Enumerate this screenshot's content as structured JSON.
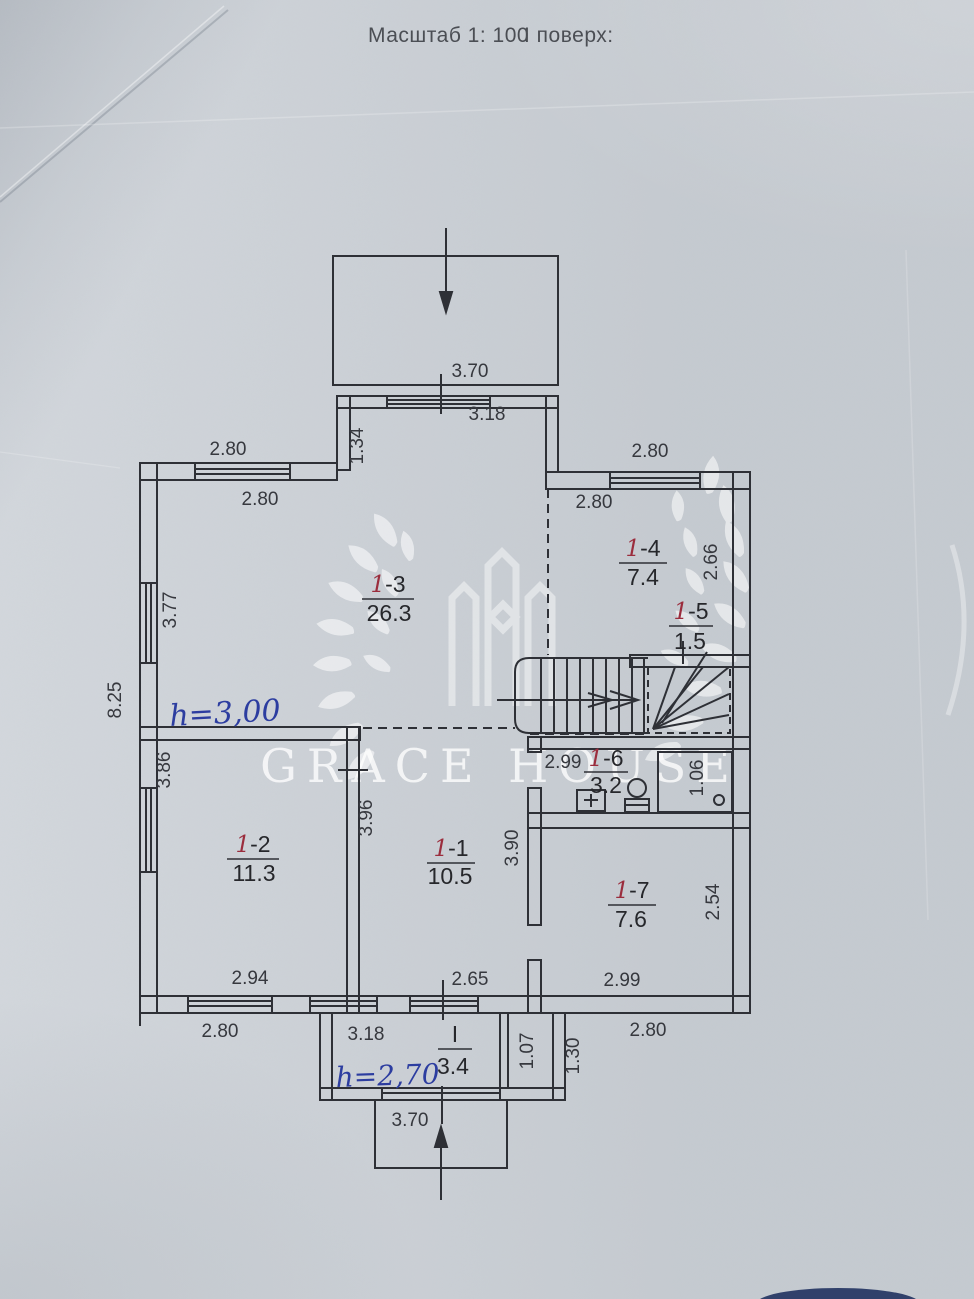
{
  "document": {
    "scale_label": "Масштаб 1: 100",
    "floor_label": "І поверх:",
    "watermark_text": "GRACE HOUSE",
    "height_note_main": "h=3,00",
    "height_note_vestibule": "h=2,70"
  },
  "colors": {
    "paper": "#cdd2d8",
    "ink": "#2e3036",
    "dimension_text": "#36383e",
    "handwritten_blue": "#2c3da0",
    "handwritten_red": "#9b2d3d",
    "watermark": "#ffffff"
  },
  "rooms": [
    {
      "id": "1-3",
      "prefix": "1",
      "suffix": "-3",
      "area": "26.3"
    },
    {
      "id": "1-4",
      "prefix": "1",
      "suffix": "-4",
      "area": "7.4"
    },
    {
      "id": "1-5",
      "prefix": "1",
      "suffix": "-5",
      "area": "1.5"
    },
    {
      "id": "1-6",
      "prefix": "1",
      "suffix": "-6",
      "area": "3.2"
    },
    {
      "id": "1-2",
      "prefix": "1",
      "suffix": "-2",
      "area": "11.3"
    },
    {
      "id": "1-1",
      "prefix": "1",
      "suffix": "-1",
      "area": "10.5"
    },
    {
      "id": "1-7",
      "prefix": "1",
      "suffix": "-7",
      "area": "7.6"
    },
    {
      "id": "I",
      "prefix": "",
      "suffix": "I",
      "area": "3.4"
    }
  ],
  "dimensions": {
    "porch_top": "3.70",
    "entry_door": "3.18",
    "top_left_outer": "2.80",
    "top_left_inner": "2.80",
    "top_right_outer": "2.80",
    "room14_width": "2.80",
    "porch_side": "1.34",
    "room13_left": "3.77",
    "left_total": "8.25",
    "room14_height": "2.66",
    "room12_left": "3.86",
    "room12_right": "3.96",
    "room11_right": "3.90",
    "room16_width": "2.99",
    "shower_width": "1.06",
    "room17_height": "2.54",
    "room12_bottom": "2.94",
    "room11_bottom": "2.65",
    "room17_bottom": "2.99",
    "bottom_left_outer": "2.80",
    "vestibule_width": "3.18",
    "bottom_right_outer": "2.80",
    "vestibule_right": "1.07",
    "vestibule_offset": "1.30",
    "porch_bottom": "3.70"
  }
}
